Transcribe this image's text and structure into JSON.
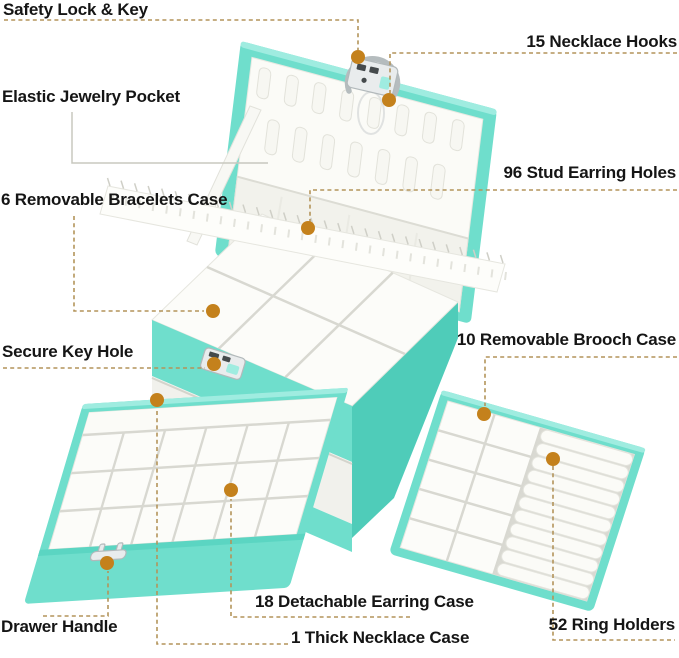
{
  "labels": [
    {
      "id": "safety-lock-key",
      "text": "Safety Lock & Key"
    },
    {
      "id": "necklace-hooks",
      "text": "15 Necklace Hooks"
    },
    {
      "id": "elastic-jewelry-pocket",
      "text": "Elastic Jewelry Pocket"
    },
    {
      "id": "stud-earring-holes",
      "text": "96 Stud Earring Holes"
    },
    {
      "id": "removable-bracelets-case",
      "text": "6 Removable Bracelets Case"
    },
    {
      "id": "secure-key-hole",
      "text": "Secure Key Hole"
    },
    {
      "id": "removable-brooch-case",
      "text": "10 Removable Brooch Case"
    },
    {
      "id": "drawer-handle",
      "text": "Drawer Handle"
    },
    {
      "id": "detachable-earring-case",
      "text": "18 Detachable Earring Case"
    },
    {
      "id": "thick-necklace-case",
      "text": "1 Thick Necklace Case"
    },
    {
      "id": "ring-holders",
      "text": "52 Ring Holders"
    }
  ],
  "colors": {
    "teal": "#6fdecc",
    "teal_light": "#9fece0",
    "teal_dark": "#4fccb9",
    "callout_dash": "#b3945a",
    "callout_dot": "#c4811c",
    "label_text": "#151515"
  }
}
